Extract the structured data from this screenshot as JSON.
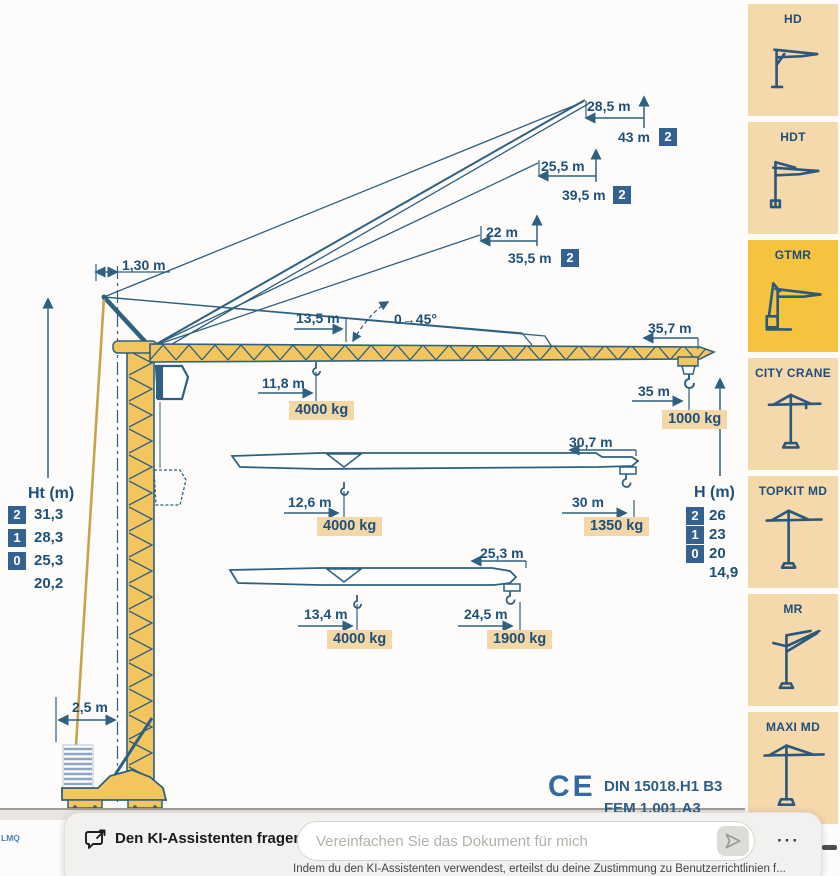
{
  "diagram": {
    "dims": {
      "r43": "28,5 m",
      "h43": "43 m",
      "r39": "25,5 m",
      "h39": "39,5 m",
      "r35": "22 m",
      "h35": "35,5 m",
      "apex_offset": "1,30 m",
      "tie_radius": "13,5 m",
      "angle_range": "0→45°",
      "jib_full": "35,7 m",
      "t1_radius": "11,8 m",
      "t1_load": "4000 kg",
      "tip1_radius": "35 m",
      "tip1_load": "1000 kg",
      "jib_mid": "30,7 m",
      "t2_radius": "12,6 m",
      "t2_load": "4000 kg",
      "tip2_radius": "30 m",
      "tip2_load": "1350 kg",
      "jib_short": "25,3 m",
      "t3_radius": "13,4 m",
      "t3_load": "4000 kg",
      "tip3_radius": "24,5 m",
      "tip3_load": "1900 kg",
      "ballast_width": "2,5 m"
    },
    "badge2": "2",
    "ht_table": {
      "title": "Ht (m)",
      "rows": [
        {
          "badge": "2",
          "value": "31,3"
        },
        {
          "badge": "1",
          "value": "28,3"
        },
        {
          "badge": "0",
          "value": "25,3"
        },
        {
          "badge": "",
          "value": "20,2"
        }
      ]
    },
    "h_table": {
      "title": "H (m)",
      "rows": [
        {
          "badge": "2",
          "value": "26"
        },
        {
          "badge": "1",
          "value": "23"
        },
        {
          "badge": "0",
          "value": "20"
        },
        {
          "badge": "",
          "value": "14,9"
        }
      ]
    },
    "certs": {
      "ce": "CE",
      "din": "DIN 15018.H1 B3",
      "fem": "FEM 1.001.A3"
    },
    "page_marker": "LMQ"
  },
  "sidebar": {
    "items": [
      {
        "label": "HD"
      },
      {
        "label": "HDT"
      },
      {
        "label": "GTMR",
        "selected": true
      },
      {
        "label": "CITY CRANE"
      },
      {
        "label": "TOPKIT MD"
      },
      {
        "label": "MR"
      },
      {
        "label": "MAXI MD"
      }
    ]
  },
  "assistant": {
    "title": "Den KI-Assistenten fragen",
    "placeholder": "Vereinfachen Sie das Dokument für mich",
    "menu_label": "···",
    "disclaimer": "Indem du den KI-Assistenten verwendest, erteilst du deine Zustimmung zu Benutzerrichtlinien f..."
  },
  "colors": {
    "accent_blue": "#2e6080",
    "crane_yellow": "#f2c55e",
    "label_peach": "#f4d7a6",
    "selected_tab": "#f5c33d",
    "panel_bg": "#f6d8ad"
  }
}
